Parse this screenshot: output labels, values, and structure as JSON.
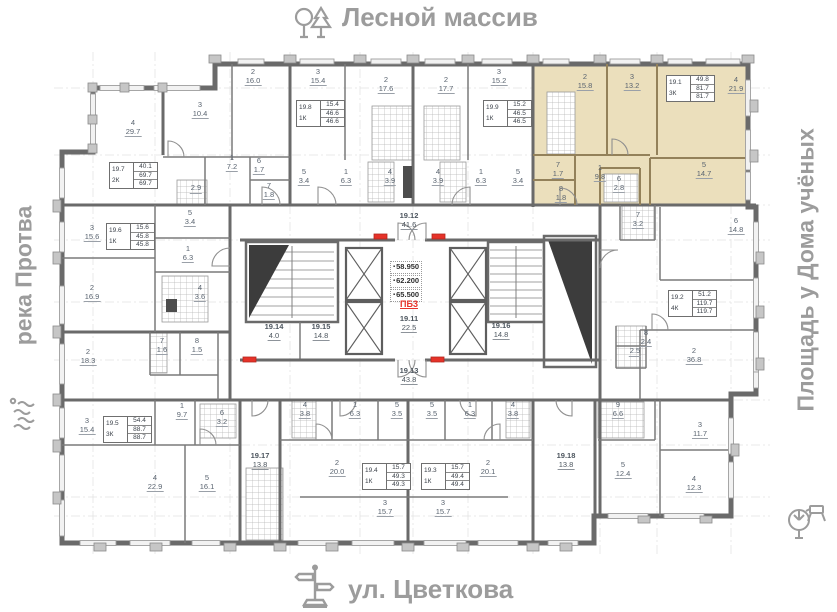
{
  "surroundings": {
    "top": {
      "label": "Лесной массив",
      "icon": "trees-icon"
    },
    "left": {
      "label": "река Протва",
      "icon": "river-waves-icon"
    },
    "right": {
      "label": "Площадь у Дома учёных",
      "icon": "park-bench-icon"
    },
    "bottom": {
      "label": "ул. Цветкова",
      "icon": "street-sign-icon"
    }
  },
  "plan": {
    "highlight_color": "#ebdfbc",
    "floor_marks": {
      "elevations": [
        "58.950",
        "62.200",
        "65.500"
      ],
      "stair_label": "ПБ3"
    },
    "corridors": [
      {
        "id": "19.12",
        "area": "41.6"
      },
      {
        "id": "19.11",
        "area": "22.5"
      },
      {
        "id": "19.13",
        "area": "43.8"
      },
      {
        "id": "19.14",
        "area": "4.0"
      },
      {
        "id": "19.15",
        "area": "14.8"
      },
      {
        "id": "19.16",
        "area": "14.8"
      },
      {
        "id": "19.17",
        "area": "13.8"
      },
      {
        "id": "19.18",
        "area": "13.8"
      }
    ],
    "apartments": [
      {
        "id": "19.7",
        "type": "2К",
        "living": "40.1",
        "total": "69.7",
        "total2": "69.7",
        "highlighted": false,
        "rooms": [
          {
            "n": "2",
            "area": "16.0"
          },
          {
            "n": "3",
            "area": "10.4"
          },
          {
            "n": "4",
            "area": "29.7"
          },
          {
            "n": "1",
            "area": "7.2"
          },
          {
            "n": "6",
            "area": "1.7"
          },
          {
            "n": "7",
            "area": "1.8"
          },
          {
            "n": "",
            "area": "2.9"
          }
        ]
      },
      {
        "id": "19.8",
        "type": "1К",
        "living": "15.4",
        "total": "46.6",
        "total2": "46.6",
        "highlighted": false,
        "rooms": [
          {
            "n": "3",
            "area": "15.4"
          },
          {
            "n": "2",
            "area": "17.6"
          },
          {
            "n": "5",
            "area": "3.4"
          },
          {
            "n": "1",
            "area": "6.3"
          },
          {
            "n": "4",
            "area": "3.9"
          }
        ]
      },
      {
        "id": "19.9",
        "type": "1К",
        "living": "15.2",
        "total": "46.5",
        "total2": "46.5",
        "highlighted": false,
        "rooms": [
          {
            "n": "2",
            "area": "17.7"
          },
          {
            "n": "3",
            "area": "15.2"
          },
          {
            "n": "4",
            "area": "3.9"
          },
          {
            "n": "1",
            "area": "6.3"
          },
          {
            "n": "5",
            "area": "3.4"
          }
        ]
      },
      {
        "id": "19.1",
        "type": "3К",
        "living": "49.8",
        "total": "81.7",
        "total2": "81.7",
        "highlighted": true,
        "rooms": [
          {
            "n": "2",
            "area": "15.8"
          },
          {
            "n": "3",
            "area": "13.2"
          },
          {
            "n": "4",
            "area": "21.9"
          },
          {
            "n": "7",
            "area": "1.7"
          },
          {
            "n": "1",
            "area": "9.8"
          },
          {
            "n": "5",
            "area": "14.7"
          },
          {
            "n": "6",
            "area": "2.8"
          },
          {
            "n": "8",
            "area": "1.8"
          }
        ]
      },
      {
        "id": "19.6",
        "type": "1К",
        "living": "15.6",
        "total": "45.8",
        "total2": "45.8",
        "highlighted": false,
        "rooms": [
          {
            "n": "3",
            "area": "15.6"
          },
          {
            "n": "5",
            "area": "3.4"
          },
          {
            "n": "1",
            "area": "6.3"
          },
          {
            "n": "2",
            "area": "16.9"
          },
          {
            "n": "4",
            "area": "3.6"
          }
        ]
      },
      {
        "id": "19.5",
        "type": "3К",
        "living": "54.4",
        "total": "88.7",
        "total2": "88.7",
        "highlighted": false,
        "rooms": [
          {
            "n": "2",
            "area": "18.3"
          },
          {
            "n": "7",
            "area": "1.6"
          },
          {
            "n": "8",
            "area": "1.5"
          },
          {
            "n": "3",
            "area": "15.4"
          },
          {
            "n": "1",
            "area": "9.7"
          },
          {
            "n": "6",
            "area": "3.2"
          },
          {
            "n": "4",
            "area": "22.9"
          },
          {
            "n": "5",
            "area": "16.1"
          }
        ]
      },
      {
        "id": "19.4",
        "type": "1К",
        "living": "15.7",
        "total": "49.3",
        "total2": "49.3",
        "highlighted": false,
        "rooms": [
          {
            "n": "4",
            "area": "3.8"
          },
          {
            "n": "1",
            "area": "6.3"
          },
          {
            "n": "5",
            "area": "3.5"
          },
          {
            "n": "2",
            "area": "20.0"
          },
          {
            "n": "3",
            "area": "15.7"
          }
        ]
      },
      {
        "id": "19.3",
        "type": "1К",
        "living": "15.7",
        "total": "49.4",
        "total2": "49.4",
        "highlighted": false,
        "rooms": [
          {
            "n": "5",
            "area": "3.5"
          },
          {
            "n": "1",
            "area": "6.3"
          },
          {
            "n": "4",
            "area": "3.8"
          },
          {
            "n": "2",
            "area": "20.1"
          },
          {
            "n": "3",
            "area": "15.7"
          }
        ]
      },
      {
        "id": "19.2",
        "type": "4К",
        "living": "51.2",
        "total": "119.7",
        "total2": "119.7",
        "highlighted": false,
        "rooms": [
          {
            "n": "6",
            "area": "14.8"
          },
          {
            "n": "7",
            "area": "3.2"
          },
          {
            "n": "8",
            "area": "2.4"
          },
          {
            "n": "",
            "area": "2.5"
          },
          {
            "n": "2",
            "area": "36.8"
          },
          {
            "n": "9",
            "area": "6.6"
          },
          {
            "n": "3",
            "area": "11.7"
          },
          {
            "n": "5",
            "area": "12.4"
          },
          {
            "n": "4",
            "area": "12.3"
          }
        ]
      }
    ]
  }
}
